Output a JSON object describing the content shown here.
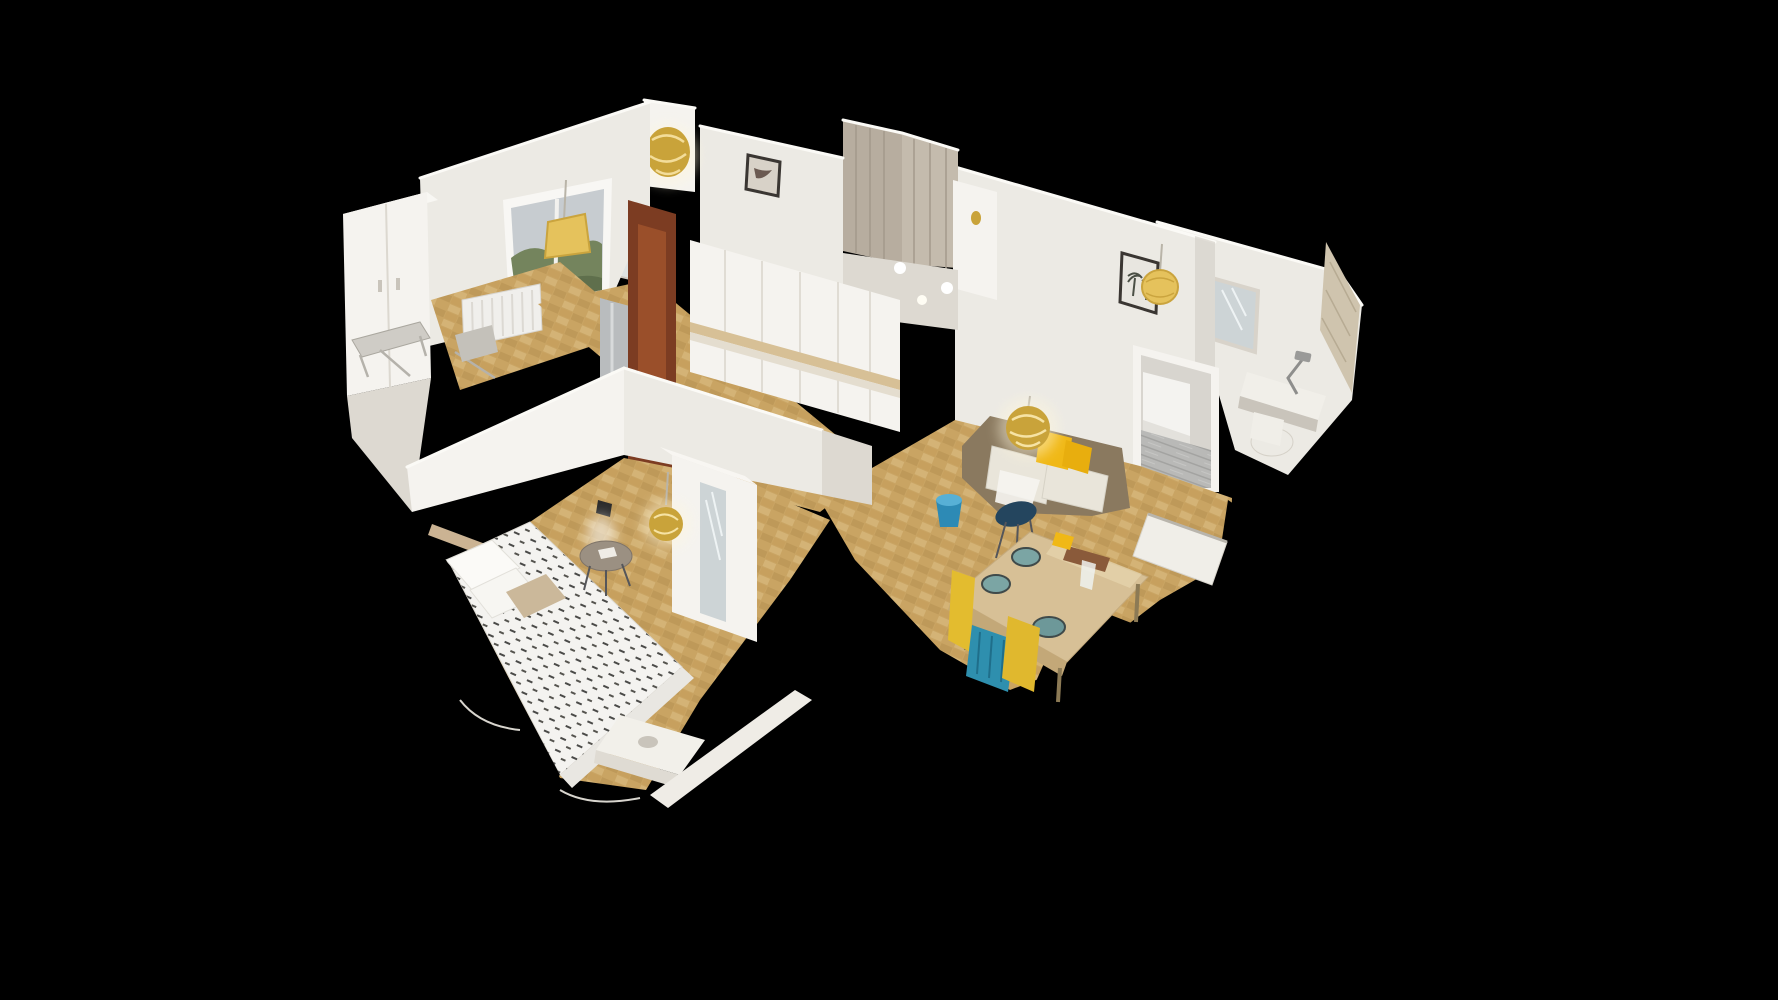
{
  "meta": {
    "app": "3d-home-tour-viewer",
    "view_mode": "dollhouse-cutaway",
    "description": "Isometric dollhouse cutaway 3D scan of a furnished apartment floating on a black background. No UI chrome, text, or controls are visible."
  },
  "scene": {
    "background": "#000000",
    "rooms": [
      {
        "name": "master-bedroom",
        "items": [
          "double-bed-white-duvet-black-dashes",
          "pillows",
          "beige-knit-cushion",
          "gold-pendant-lamp",
          "round-side-table",
          "white-wardrobe-with-mirror",
          "wall-sconce",
          "white-desk"
        ]
      },
      {
        "name": "living-dining-room",
        "items": [
          "brown-sofa-cream-cushions",
          "yellow-throw-pillows",
          "gold-sparkle-pendant",
          "wood-dining-table",
          "teal-bowls",
          "yellow-chairs",
          "teal-chair",
          "navy-chair",
          "blue-bucket",
          "white-bench"
        ]
      },
      {
        "name": "kitchen",
        "items": [
          "white-cabinets",
          "tan-countertop",
          "stainless-fridge",
          "dark-wood-door-frame"
        ]
      },
      {
        "name": "window-room",
        "items": [
          "large-window-with-trees",
          "yellow-lampshade",
          "white-wardrobe",
          "radiator",
          "drying-rack"
        ]
      },
      {
        "name": "hallway",
        "items": [
          "parquet-floor",
          "gold-chandelier",
          "framed-picture",
          "mirror-door"
        ]
      },
      {
        "name": "second-bedroom",
        "items": [
          "white-bed",
          "grey-plank-floor",
          "doorway"
        ]
      },
      {
        "name": "vanity-corner",
        "items": [
          "wall-mirror",
          "white-desk",
          "desk-lamp",
          "white-chair",
          "beige-marble-tiles",
          "palm-tree-picture",
          "straw-pendant-lamp"
        ]
      }
    ],
    "colors": {
      "background": "#000000",
      "wall_bright": "#f5f3ef",
      "wall_light": "#eceae4",
      "wall_mid": "#ddd9d1",
      "wall_shade": "#c9c4bb",
      "floor_parquet": "#c9a463",
      "parquet_dark": "#b18c4e",
      "parquet_light": "#dcbf84",
      "floor_grey": "#b9b9b7",
      "grey_plank": "#a9a9a7",
      "wood_door": "#7c3c22",
      "steel": "#b9bcbe",
      "sofa_brown": "#8a795f",
      "cushion_cream": "#e9e5da",
      "pillow_yellow": "#f0b816",
      "table_wood": "#d7c096",
      "bowl_teal": "#7ba5a4",
      "chair_yellow": "#e3bc2f",
      "chair_teal": "#2e8fae",
      "chair_navy": "#24455e",
      "bucket_blue": "#2d8ab5",
      "gold_lamp": "#c9a33a",
      "straw_lamp": "#e5c25c",
      "window_sky": "#c7ccd0",
      "window_tree": "#74845d",
      "marble_tile": "#cfc4ae",
      "mirror_glass": "#cdd4d6",
      "duvet_white": "#f4f3f0",
      "duvet_dash": "#4a4a48",
      "pillow_beige": "#cbb89a",
      "frame_dark": "#3a3632"
    }
  }
}
